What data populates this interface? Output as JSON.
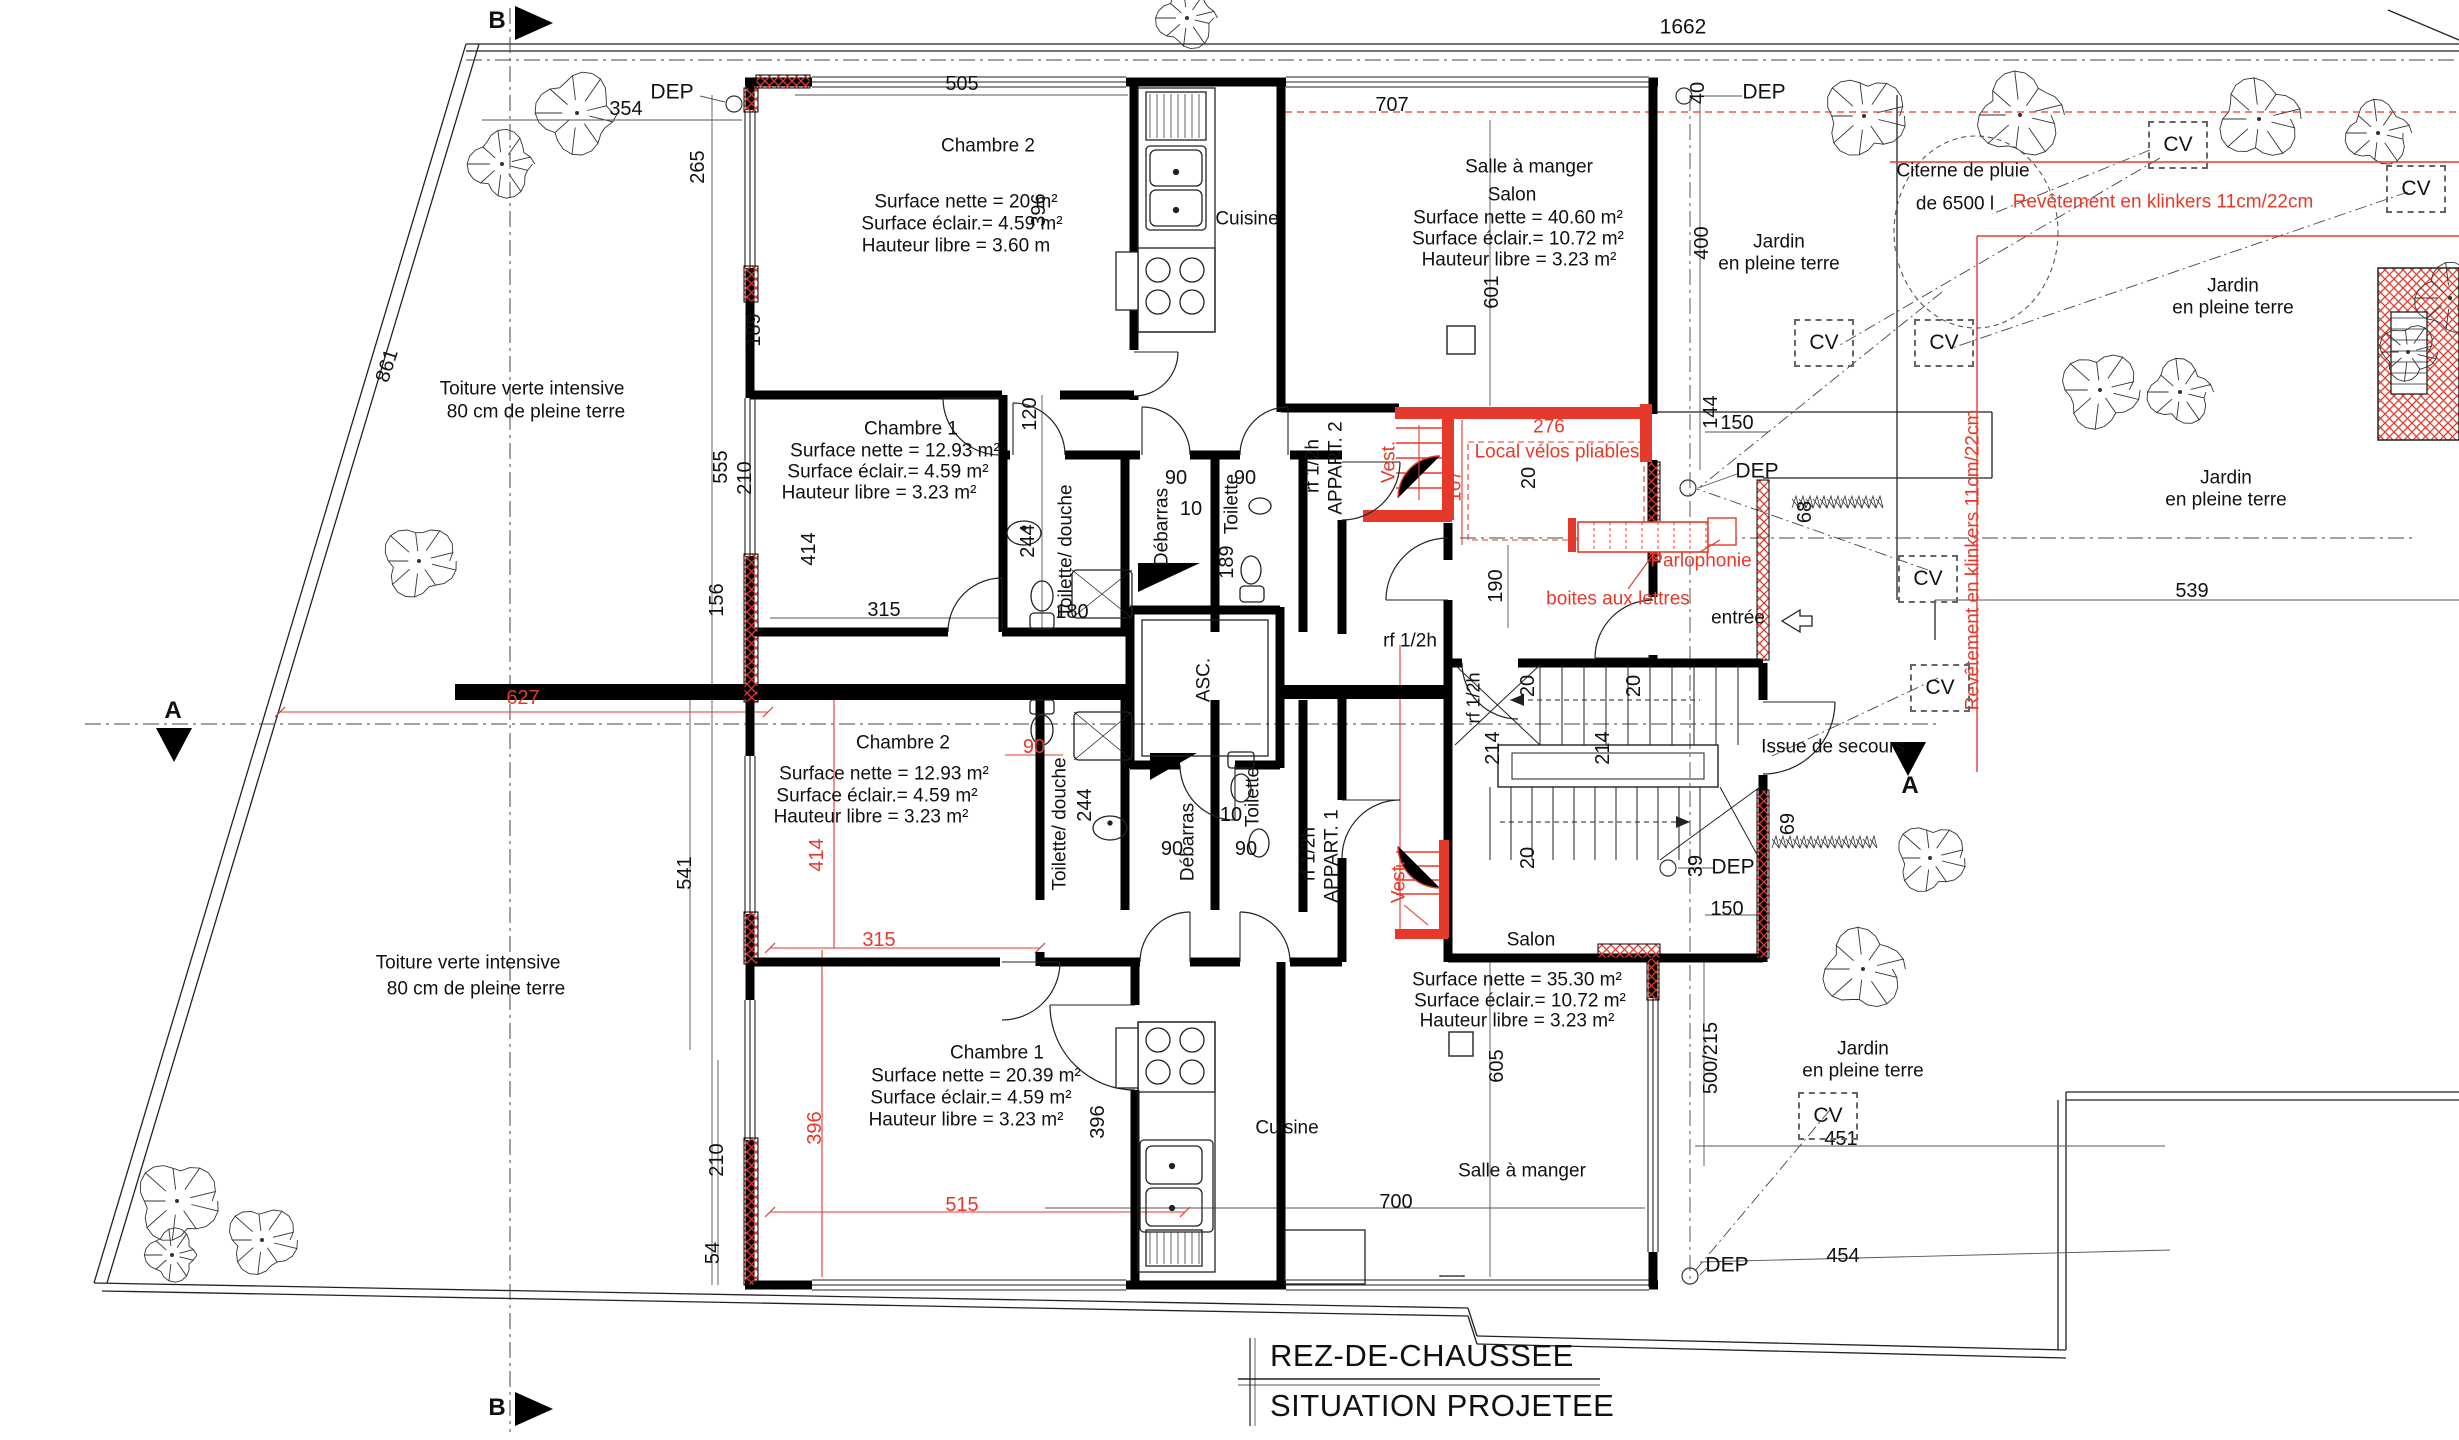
{
  "drawing": {
    "title_line1": "REZ-DE-CHAUSSEE",
    "title_line2": "SITUATION PROJETEE",
    "accent_red": "#e53a2b",
    "ink": "#111111"
  },
  "cv_markers": [
    {
      "x": 2178,
      "y": 145
    },
    {
      "x": 2416,
      "y": 189
    },
    {
      "x": 1824,
      "y": 343
    },
    {
      "x": 1944,
      "y": 343
    },
    {
      "x": 1928,
      "y": 579
    },
    {
      "x": 1940,
      "y": 688
    },
    {
      "x": 1828,
      "y": 1116
    }
  ],
  "labels": [
    {
      "t": "B",
      "x": 497,
      "y": 21,
      "s": 24,
      "w": 700
    },
    {
      "t": "B",
      "x": 497,
      "y": 1408,
      "s": 24,
      "w": 700
    },
    {
      "t": "A",
      "x": 173,
      "y": 711,
      "s": 24,
      "w": 700
    },
    {
      "t": "A",
      "x": 1910,
      "y": 786,
      "s": 24,
      "w": 700
    },
    {
      "t": "1662",
      "x": 1683,
      "y": 28,
      "s": 21
    },
    {
      "t": "DEP",
      "x": 672,
      "y": 93,
      "s": 21
    },
    {
      "t": "354",
      "x": 626,
      "y": 110,
      "s": 20
    },
    {
      "t": "505",
      "x": 962,
      "y": 85,
      "s": 20
    },
    {
      "t": "707",
      "x": 1392,
      "y": 106,
      "s": 20
    },
    {
      "t": "Chambre 2",
      "x": 988,
      "y": 147,
      "s": 19
    },
    {
      "t": "Surface nette = 20 m²",
      "x": 966,
      "y": 203,
      "s": 19
    },
    {
      "t": "Surface éclair.= 4.59 m²",
      "x": 962,
      "y": 225,
      "s": 19
    },
    {
      "t": "Hauteur libre = 3.60 m",
      "x": 956,
      "y": 247,
      "s": 19
    },
    {
      "t": "265",
      "x": 699,
      "y": 167,
      "s": 20,
      "r": -90
    },
    {
      "t": "396",
      "x": 1040,
      "y": 210,
      "s": 20,
      "r": -90
    },
    {
      "t": "189",
      "x": 755,
      "y": 330,
      "s": 20,
      "r": -90
    },
    {
      "t": "Cuisine",
      "x": 1247,
      "y": 220,
      "s": 19
    },
    {
      "t": "Salle à manger",
      "x": 1529,
      "y": 168,
      "s": 19
    },
    {
      "t": "Salon",
      "x": 1512,
      "y": 196,
      "s": 19
    },
    {
      "t": "Surface nette = 40.60 m²",
      "x": 1518,
      "y": 219,
      "s": 19
    },
    {
      "t": "Surface éclair.= 10.72 m²",
      "x": 1518,
      "y": 240,
      "s": 19
    },
    {
      "t": "Hauteur libre = 3.23 m²",
      "x": 1519,
      "y": 261,
      "s": 19
    },
    {
      "t": "601",
      "x": 1493,
      "y": 292,
      "s": 20,
      "r": -90
    },
    {
      "t": "400",
      "x": 1703,
      "y": 243,
      "s": 20,
      "r": -90
    },
    {
      "t": "40",
      "x": 1699,
      "y": 93,
      "s": 20,
      "r": -90
    },
    {
      "t": "DEP",
      "x": 1764,
      "y": 93,
      "s": 21
    },
    {
      "t": "Jardin",
      "x": 1779,
      "y": 243,
      "s": 19
    },
    {
      "t": "en pleine terre",
      "x": 1779,
      "y": 265,
      "s": 19
    },
    {
      "t": "Citerne de pluie",
      "x": 1963,
      "y": 172,
      "s": 19
    },
    {
      "t": "de 6500 l",
      "x": 1955,
      "y": 205,
      "s": 19
    },
    {
      "t": "Revêtement en klinkers 11cm/22cm",
      "x": 2163,
      "y": 203,
      "s": 19,
      "c": "#e53a2b"
    },
    {
      "t": "Jardin",
      "x": 2233,
      "y": 287,
      "s": 19
    },
    {
      "t": "en pleine terre",
      "x": 2233,
      "y": 309,
      "s": 19
    },
    {
      "t": "Jardin",
      "x": 2226,
      "y": 479,
      "s": 19
    },
    {
      "t": "en pleine terre",
      "x": 2226,
      "y": 501,
      "s": 19
    },
    {
      "t": "539",
      "x": 2192,
      "y": 592,
      "s": 20
    },
    {
      "t": "861",
      "x": 388,
      "y": 366,
      "s": 20,
      "r": -72
    },
    {
      "t": "Toiture verte intensive",
      "x": 532,
      "y": 390,
      "s": 19
    },
    {
      "t": "80 cm de pleine terre",
      "x": 536,
      "y": 413,
      "s": 19
    },
    {
      "t": "555",
      "x": 722,
      "y": 467,
      "s": 20,
      "r": -90
    },
    {
      "t": "210",
      "x": 746,
      "y": 478,
      "s": 20,
      "r": -90
    },
    {
      "t": "Chambre 1",
      "x": 911,
      "y": 430,
      "s": 19
    },
    {
      "t": "Surface nette = 12.93 m²",
      "x": 895,
      "y": 452,
      "s": 19
    },
    {
      "t": "Surface éclair.= 4.59 m²",
      "x": 888,
      "y": 473,
      "s": 19
    },
    {
      "t": "Hauteur libre = 3.23 m²",
      "x": 879,
      "y": 494,
      "s": 19
    },
    {
      "t": "414",
      "x": 810,
      "y": 549,
      "s": 20,
      "r": -90
    },
    {
      "t": "120",
      "x": 1031,
      "y": 414,
      "s": 20,
      "r": -90
    },
    {
      "t": "244",
      "x": 1029,
      "y": 541,
      "s": 20,
      "r": -90
    },
    {
      "t": "Toilette/ douche",
      "x": 1067,
      "y": 551,
      "s": 19,
      "r": -90
    },
    {
      "t": "180",
      "x": 1072,
      "y": 613,
      "s": 20
    },
    {
      "t": "Débarras",
      "x": 1163,
      "y": 527,
      "s": 19,
      "r": -90
    },
    {
      "t": "90",
      "x": 1176,
      "y": 479,
      "s": 20
    },
    {
      "t": "10",
      "x": 1191,
      "y": 510,
      "s": 20
    },
    {
      "t": "Toilette",
      "x": 1233,
      "y": 504,
      "s": 19,
      "r": -90
    },
    {
      "t": "189",
      "x": 1228,
      "y": 562,
      "s": 20,
      "r": -90
    },
    {
      "t": "90",
      "x": 1245,
      "y": 479,
      "s": 20
    },
    {
      "t": "156",
      "x": 718,
      "y": 600,
      "s": 20,
      "r": -90
    },
    {
      "t": "315",
      "x": 884,
      "y": 611,
      "s": 20
    },
    {
      "t": "rf 1/2h",
      "x": 1314,
      "y": 466,
      "s": 19,
      "r": -90
    },
    {
      "t": "APPART. 2",
      "x": 1337,
      "y": 468,
      "s": 19,
      "r": -90
    },
    {
      "t": "Vest.",
      "x": 1390,
      "y": 462,
      "s": 19,
      "r": -90,
      "c": "#e53a2b"
    },
    {
      "t": "167",
      "x": 1456,
      "y": 486,
      "s": 19,
      "r": -90,
      "c": "#e53a2b"
    },
    {
      "t": "276",
      "x": 1549,
      "y": 428,
      "s": 19,
      "c": "#e53a2b"
    },
    {
      "t": "Local vélos pliables",
      "x": 1557,
      "y": 453,
      "s": 19,
      "c": "#e53a2b"
    },
    {
      "t": "20",
      "x": 1530,
      "y": 478,
      "s": 20,
      "r": -90
    },
    {
      "t": "144",
      "x": 1712,
      "y": 412,
      "s": 20,
      "r": -90
    },
    {
      "t": "150",
      "x": 1737,
      "y": 424,
      "s": 20
    },
    {
      "t": "DEP",
      "x": 1757,
      "y": 472,
      "s": 21
    },
    {
      "t": "68",
      "x": 1806,
      "y": 512,
      "s": 20,
      "r": -90
    },
    {
      "t": "190",
      "x": 1497,
      "y": 586,
      "s": 20,
      "r": -90
    },
    {
      "t": "Parlophonie",
      "x": 1701,
      "y": 562,
      "s": 19,
      "c": "#e53a2b"
    },
    {
      "t": "boites aux lettres",
      "x": 1618,
      "y": 600,
      "s": 19,
      "c": "#e53a2b"
    },
    {
      "t": "entrée",
      "x": 1738,
      "y": 619,
      "s": 19
    },
    {
      "t": "rf 1/2h",
      "x": 1410,
      "y": 642,
      "s": 19
    },
    {
      "t": "627",
      "x": 523,
      "y": 699,
      "s": 20,
      "c": "#e53a2b"
    },
    {
      "t": "90",
      "x": 1034,
      "y": 748,
      "s": 20,
      "c": "#e53a2b"
    },
    {
      "t": "Chambre 2",
      "x": 903,
      "y": 744,
      "s": 19
    },
    {
      "t": "Surface nette = 12.93 m²",
      "x": 884,
      "y": 775,
      "s": 19
    },
    {
      "t": "Surface éclair.= 4.59 m²",
      "x": 877,
      "y": 797,
      "s": 19
    },
    {
      "t": "Hauteur libre = 3.23 m²",
      "x": 871,
      "y": 818,
      "s": 19
    },
    {
      "t": "414",
      "x": 818,
      "y": 855,
      "s": 20,
      "r": -90,
      "c": "#e53a2b"
    },
    {
      "t": "Toilette/ douche",
      "x": 1061,
      "y": 824,
      "s": 19,
      "r": -90
    },
    {
      "t": "244",
      "x": 1086,
      "y": 805,
      "s": 20,
      "r": -90
    },
    {
      "t": "Débarras",
      "x": 1189,
      "y": 842,
      "s": 19,
      "r": -90
    },
    {
      "t": "90",
      "x": 1172,
      "y": 850,
      "s": 20
    },
    {
      "t": "10",
      "x": 1231,
      "y": 816,
      "s": 20
    },
    {
      "t": "Toilette",
      "x": 1254,
      "y": 797,
      "s": 19,
      "r": -90
    },
    {
      "t": "90",
      "x": 1246,
      "y": 850,
      "s": 20
    },
    {
      "t": "rf 1/2h",
      "x": 1310,
      "y": 854,
      "s": 19,
      "r": -90
    },
    {
      "t": "APPART. 1",
      "x": 1333,
      "y": 856,
      "s": 19,
      "r": -90
    },
    {
      "t": "Vest.",
      "x": 1400,
      "y": 882,
      "s": 19,
      "r": -90,
      "c": "#e53a2b"
    },
    {
      "t": "ASC.",
      "x": 1205,
      "y": 680,
      "s": 19,
      "r": -90
    },
    {
      "t": "20",
      "x": 1529,
      "y": 686,
      "s": 20,
      "r": -90
    },
    {
      "t": "20",
      "x": 1635,
      "y": 686,
      "s": 20,
      "r": -90
    },
    {
      "t": "214",
      "x": 1494,
      "y": 748,
      "s": 20,
      "r": -90
    },
    {
      "t": "214",
      "x": 1604,
      "y": 748,
      "s": 20,
      "r": -90
    },
    {
      "t": "rf 1/2h",
      "x": 1474,
      "y": 698,
      "s": 18,
      "r": -90
    },
    {
      "t": "Issue de secours",
      "x": 1833,
      "y": 748,
      "s": 19
    },
    {
      "t": "Revêtement en klinkers 11cm/22cm",
      "x": 1974,
      "y": 560,
      "s": 19,
      "r": -90,
      "c": "#e53a2b"
    },
    {
      "t": "69",
      "x": 1789,
      "y": 824,
      "s": 20,
      "r": -90
    },
    {
      "t": "20",
      "x": 1529,
      "y": 858,
      "s": 20,
      "r": -90
    },
    {
      "t": "39",
      "x": 1697,
      "y": 866,
      "s": 20,
      "r": -90
    },
    {
      "t": "DEP",
      "x": 1733,
      "y": 868,
      "s": 21
    },
    {
      "t": "150",
      "x": 1727,
      "y": 910,
      "s": 20
    },
    {
      "t": "Salon",
      "x": 1531,
      "y": 941,
      "s": 19
    },
    {
      "t": "Surface nette = 35.30 m²",
      "x": 1517,
      "y": 981,
      "s": 19
    },
    {
      "t": "Surface éclair.= 10.72 m²",
      "x": 1520,
      "y": 1002,
      "s": 19
    },
    {
      "t": "Hauteur libre = 3.23 m²",
      "x": 1517,
      "y": 1022,
      "s": 19
    },
    {
      "t": "605",
      "x": 1498,
      "y": 1066,
      "s": 20,
      "r": -90
    },
    {
      "t": "500/215",
      "x": 1712,
      "y": 1058,
      "s": 20,
      "r": -90
    },
    {
      "t": "Jardin",
      "x": 1863,
      "y": 1050,
      "s": 19
    },
    {
      "t": "en pleine terre",
      "x": 1863,
      "y": 1072,
      "s": 19
    },
    {
      "t": "451",
      "x": 1841,
      "y": 1140,
      "s": 20
    },
    {
      "t": "454",
      "x": 1843,
      "y": 1257,
      "s": 20
    },
    {
      "t": "DEP",
      "x": 1727,
      "y": 1266,
      "s": 21
    },
    {
      "t": "Toiture verte intensive",
      "x": 468,
      "y": 964,
      "s": 19
    },
    {
      "t": "80 cm de pleine terre",
      "x": 476,
      "y": 990,
      "s": 19
    },
    {
      "t": "541",
      "x": 686,
      "y": 873,
      "s": 20,
      "r": -90
    },
    {
      "t": "315",
      "x": 879,
      "y": 941,
      "s": 20,
      "c": "#e53a2b"
    },
    {
      "t": "Chambre 1",
      "x": 997,
      "y": 1054,
      "s": 19
    },
    {
      "t": "Surface nette = 20.39 m²",
      "x": 976,
      "y": 1077,
      "s": 19
    },
    {
      "t": "Surface éclair.= 4.59 m²",
      "x": 971,
      "y": 1099,
      "s": 19
    },
    {
      "t": "Hauteur libre = 3.23 m²",
      "x": 966,
      "y": 1121,
      "s": 19
    },
    {
      "t": "396",
      "x": 816,
      "y": 1128,
      "s": 20,
      "r": -90,
      "c": "#e53a2b"
    },
    {
      "t": "396",
      "x": 1099,
      "y": 1122,
      "s": 20,
      "r": -90
    },
    {
      "t": "210",
      "x": 718,
      "y": 1160,
      "s": 20,
      "r": -90
    },
    {
      "t": "54",
      "x": 714,
      "y": 1253,
      "s": 20,
      "r": -90
    },
    {
      "t": "515",
      "x": 962,
      "y": 1206,
      "s": 20,
      "c": "#e53a2b"
    },
    {
      "t": "Cuisine",
      "x": 1287,
      "y": 1129,
      "s": 19
    },
    {
      "t": "Salle à manger",
      "x": 1522,
      "y": 1172,
      "s": 19
    },
    {
      "t": "700",
      "x": 1396,
      "y": 1203,
      "s": 20
    }
  ]
}
